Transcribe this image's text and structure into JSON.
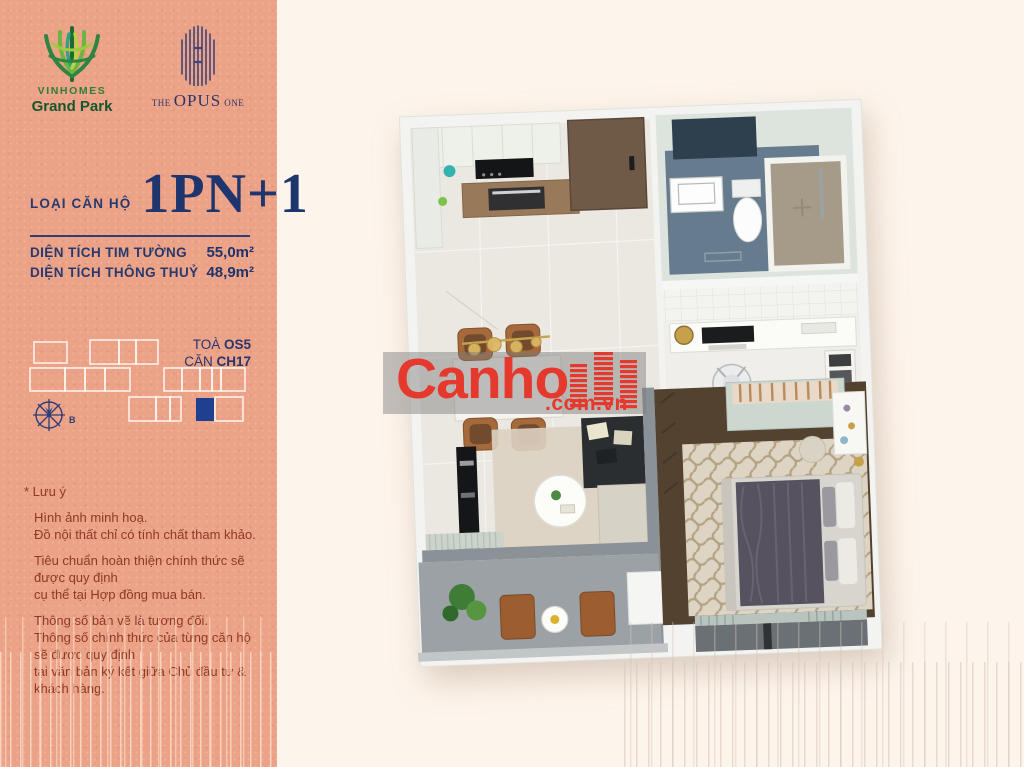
{
  "branding": {
    "vinhomes": {
      "wordmark": "VINHOMES",
      "subtitle": "Grand Park"
    },
    "opus": {
      "the": "THE",
      "opus": "OPUS",
      "one": "ONE"
    }
  },
  "unit_info": {
    "type_label": "LOẠI CĂN HỘ",
    "type_value": "1PN+1",
    "areas": [
      {
        "label": "DIỆN TÍCH TIM TƯỜNG",
        "value": "55,0m²"
      },
      {
        "label": "DIỆN TÍCH THÔNG THUỶ",
        "value": "48,9m²"
      }
    ]
  },
  "location": {
    "building_label": "TOÀ",
    "building_value": "OS5",
    "unit_label": "CĂN",
    "unit_value": "CH17",
    "compass_north": "B"
  },
  "notes": {
    "title": "* Lưu ý",
    "paragraphs": [
      [
        "Hình ảnh minh hoạ.",
        "Đồ nội thất chỉ có tính chất tham khảo."
      ],
      [
        "Tiêu chuẩn hoàn thiện chính thức sẽ được quy định",
        "cụ thể tại Hợp đồng mua bán."
      ],
      [
        "Thông số bản vẽ là tương đối.",
        "Thông số chính thức của từng căn hộ sẽ được quy định",
        "tại văn bản ký kết giữa Chủ đầu tư & khách hàng."
      ]
    ]
  },
  "watermark": {
    "brand": "Canho",
    "domain": ".com.vn"
  },
  "colors": {
    "sidebar_bg": "#eca287",
    "main_bg": "#fdf5ec",
    "accent_navy": "#1f3f8f",
    "navy_text": "#27356a",
    "brand_red": "#e6392e",
    "note_text": "#8d3a26",
    "vinhomes_green": "#2e7d3a",
    "watermark_band": "rgba(122,122,122,0.45)"
  }
}
